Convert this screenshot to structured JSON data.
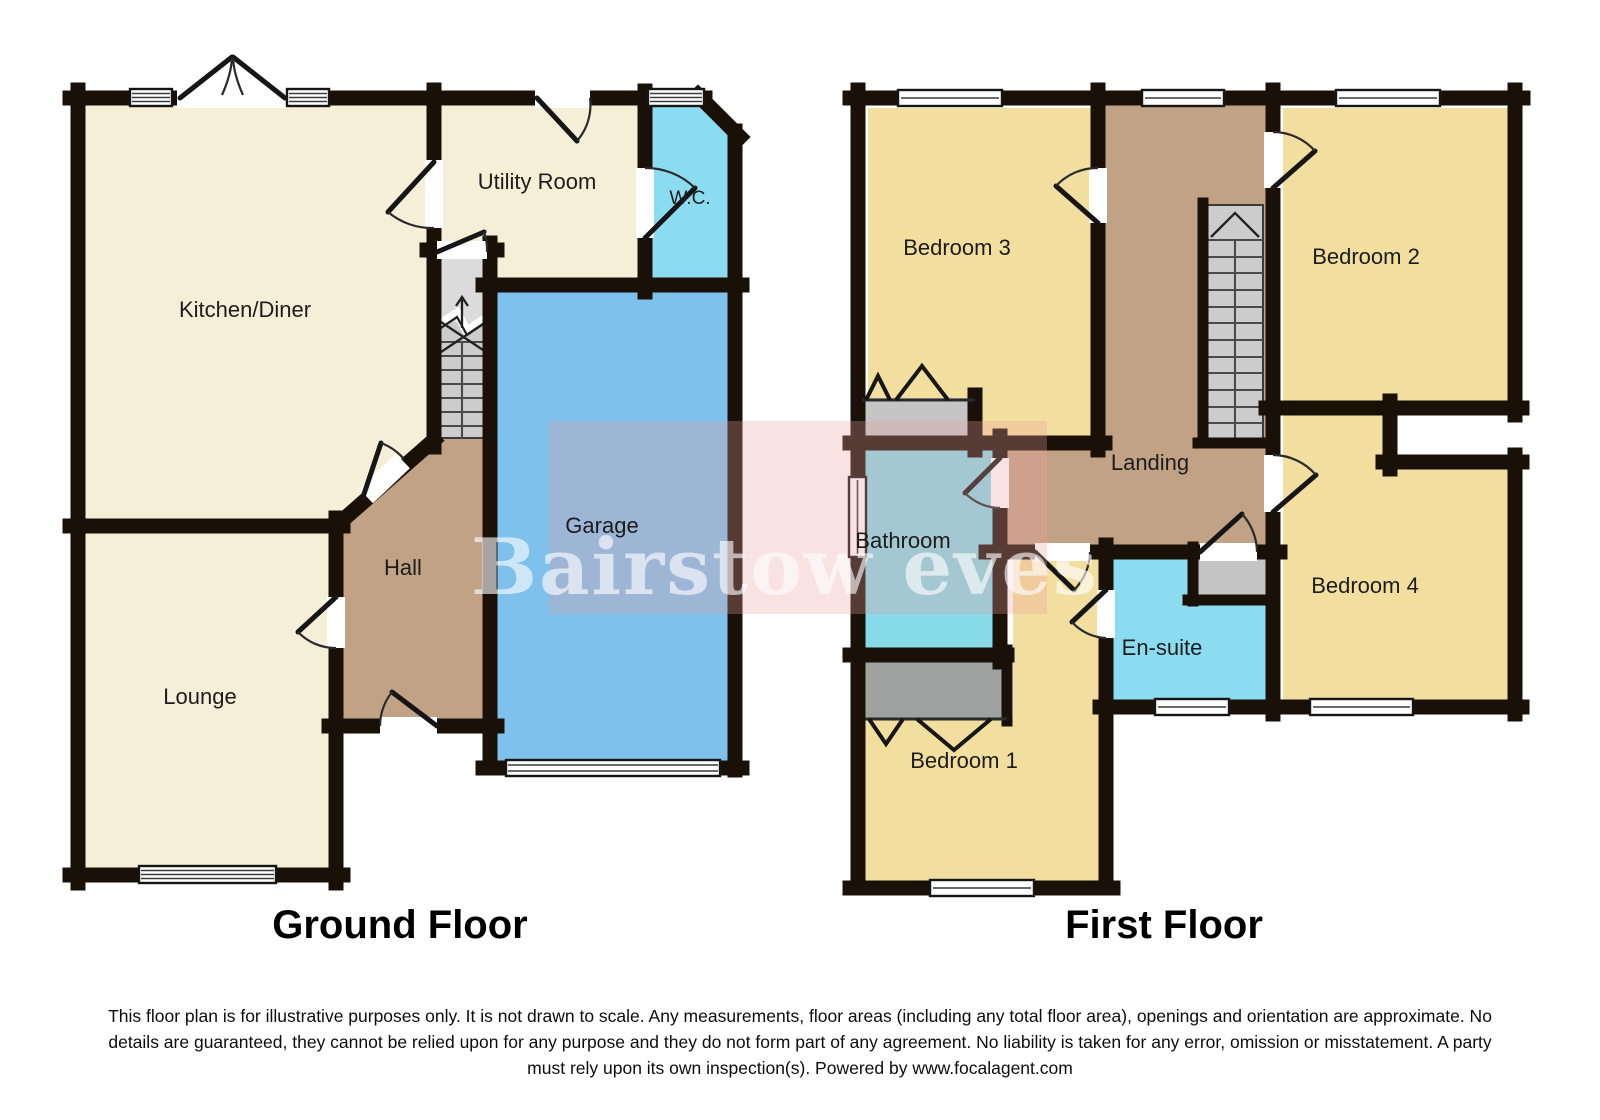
{
  "ground_floor": {
    "title": "Ground Floor",
    "rooms": {
      "kitchen_diner": "Kitchen/Diner",
      "utility_room": "Utility Room",
      "wc": "W.C.",
      "garage": "Garage",
      "hall": "Hall",
      "lounge": "Lounge"
    }
  },
  "first_floor": {
    "title": "First Floor",
    "rooms": {
      "bedroom1": "Bedroom 1",
      "bedroom2": "Bedroom 2",
      "bedroom3": "Bedroom 3",
      "bedroom4": "Bedroom 4",
      "landing": "Landing",
      "bathroom": "Bathroom",
      "ensuite": "En-suite"
    }
  },
  "watermark": {
    "text": "Bairstow eves",
    "overlay_color": "rgba(231,158,158,0.30)",
    "text_color": "rgba(255,255,255,0.62)"
  },
  "disclaimer": {
    "lines": [
      "This floor plan is for illustrative purposes only. It is not drawn to scale. Any measurements, floor areas (including any total floor area), openings and orientation are approximate. No",
      "details are guaranteed, they cannot be relied upon for any purpose and they do not form part of any agreement. No liability is taken for any error, omission or misstatement. A party",
      "must rely upon its own inspection(s). Powered by www.focalagent.com"
    ]
  },
  "colors": {
    "wall": "#191008",
    "cream": "#F6EFD8",
    "yellow": "#F2DE9E",
    "brown": "#C2A284",
    "blue": "#7FC1ED",
    "cyan": "#8BDCF1",
    "teal": "#87DAE8",
    "stair_gray": "#CCCCCC",
    "stair_gray_light": "#DBDBDB",
    "cupboard_gray": "#C5C5C5",
    "wardrobe_gray": "#9FA0A0"
  }
}
